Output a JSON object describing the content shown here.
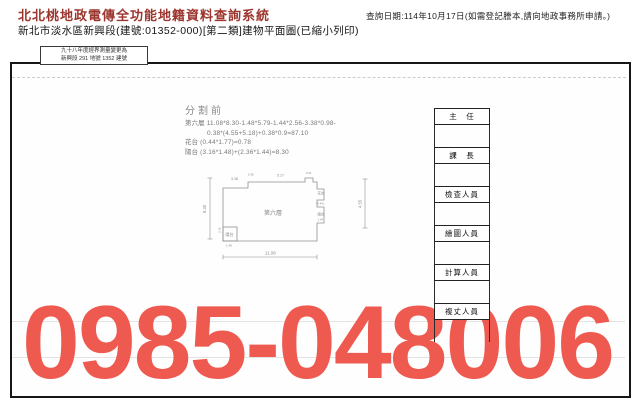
{
  "header": {
    "system_title": "北北桃地政電傳全功能地籍資料查詢系統",
    "query_date": "查詢日期:114年10月17日(如需登記謄本,請向地政事務所申請。)",
    "document_title": "新北市淡水區新興段(建號:01352-000)[第二類]建物平面圖(已縮小列印)"
  },
  "document": {
    "remark_line1": "九十八年度經界測量變更為",
    "remark_line2": "新興段 291 地號 1352 建號",
    "section_label": "分割前",
    "calc_line1": "第六層 11.08*8.30-1.48*5.79-1.44*2.56-3.38*0.98-",
    "calc_line2": "0.38*(4.55+5.18)+0.38*0.9=87.10",
    "calc_line3": "花台 (0.44*1.77)=0.78",
    "calc_line4": "陽台 (3.16*1.48)+(2.36*1.44)=8.30",
    "plan": {
      "room_label": "第六層",
      "dim_bottom": "11.08",
      "dim_left": "8.30",
      "dim_right": "4.55",
      "dim_top_left": "3.38",
      "dim_top_small1": "0.38",
      "dim_top_mid": "5.17",
      "dim_top_small2": "0.91",
      "flower_box_label": "花台",
      "flower_box_dim": "(0.44)",
      "balcony_right_label": "陽台",
      "balcony_right_dim": "1.44",
      "balcony_left_label": "陽台",
      "balcony_left_dim_w": "1.48",
      "balcony_left_dim_h": "3.16"
    },
    "signatures": [
      "主　任",
      "課　長",
      "檢查人員",
      "繪圖人員",
      "計算人員",
      "複丈人員"
    ]
  },
  "overlay": {
    "phone_number": "0985-048006",
    "phone_color": "#ef5a50"
  }
}
